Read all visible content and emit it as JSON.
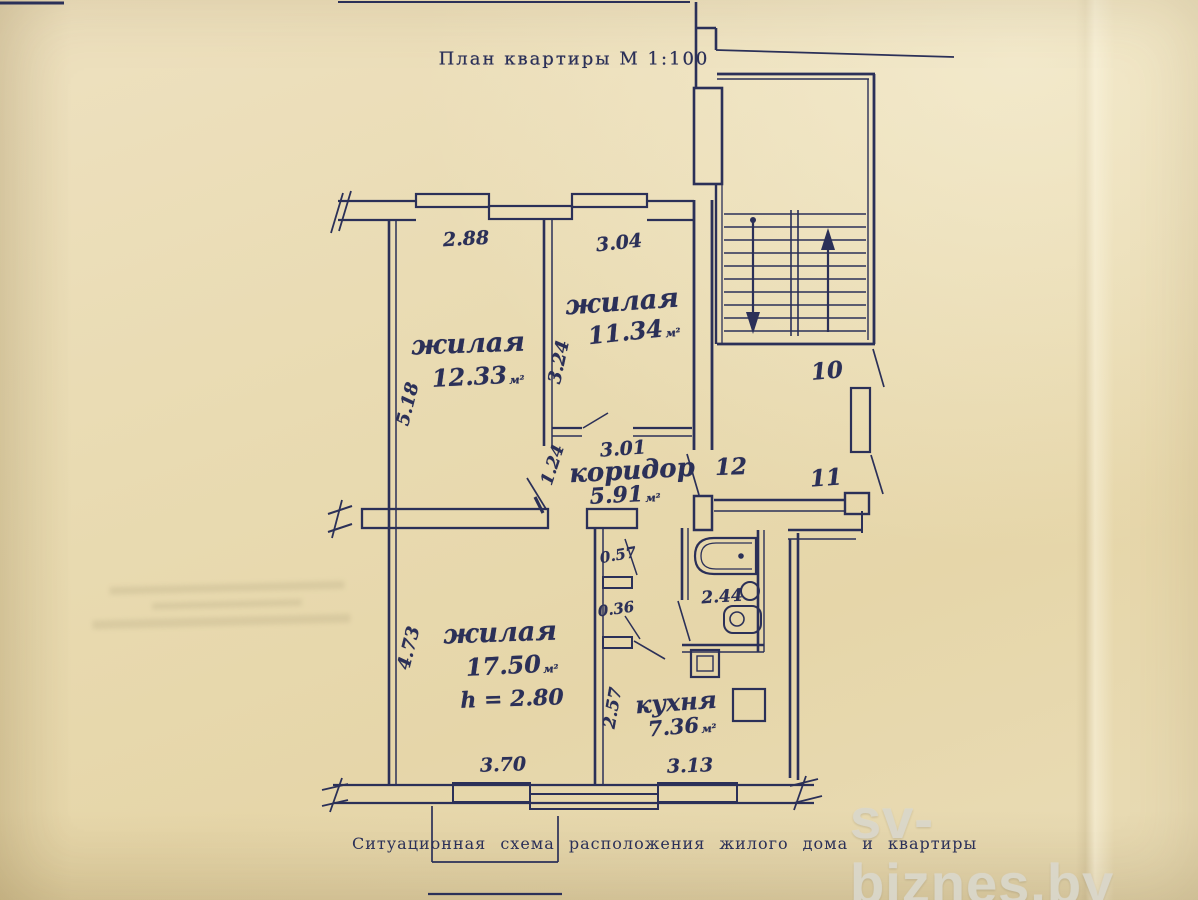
{
  "colors": {
    "ink": "#2b3058",
    "paper": "#e9dcb2",
    "watermark": "#dad7ca",
    "stamp": "#9c8f6a"
  },
  "title": {
    "text": "План квартиры М 1:100"
  },
  "caption": {
    "text": "Ситуационная схема расположения жилого дома и квартиры"
  },
  "watermark": {
    "text": "sv-biznes.by"
  },
  "rooms": {
    "living1": {
      "name": "жилая",
      "area": "12.33",
      "unit": "м²"
    },
    "living2": {
      "name": "жилая",
      "area": "11.34",
      "unit": "м²"
    },
    "living3": {
      "name": "жилая",
      "area": "17.50",
      "unit": "м²",
      "height_note": "h = 2.80"
    },
    "corridor": {
      "name": "коридор",
      "area": "5.91",
      "unit": "м²"
    },
    "kitchen": {
      "name": "кухня",
      "area": "7.36",
      "unit": "м²"
    }
  },
  "dimensions": {
    "room1_width": "2.88",
    "room2_width": "3.04",
    "room1_depth": "5.18",
    "room2_depth": "3.24",
    "room1_door": "1.24",
    "corridor_width": "3.01",
    "room3_depth": "4.73",
    "closet_upper": "0.57",
    "closet_lower": "0.36",
    "kitchen_depth": "2.57",
    "bathroom_width": "2.44",
    "room3_width": "3.70",
    "kitchen_width": "3.13"
  },
  "hall_numbers": {
    "landing": "10",
    "hall_left": "12",
    "hall_right": "11"
  }
}
